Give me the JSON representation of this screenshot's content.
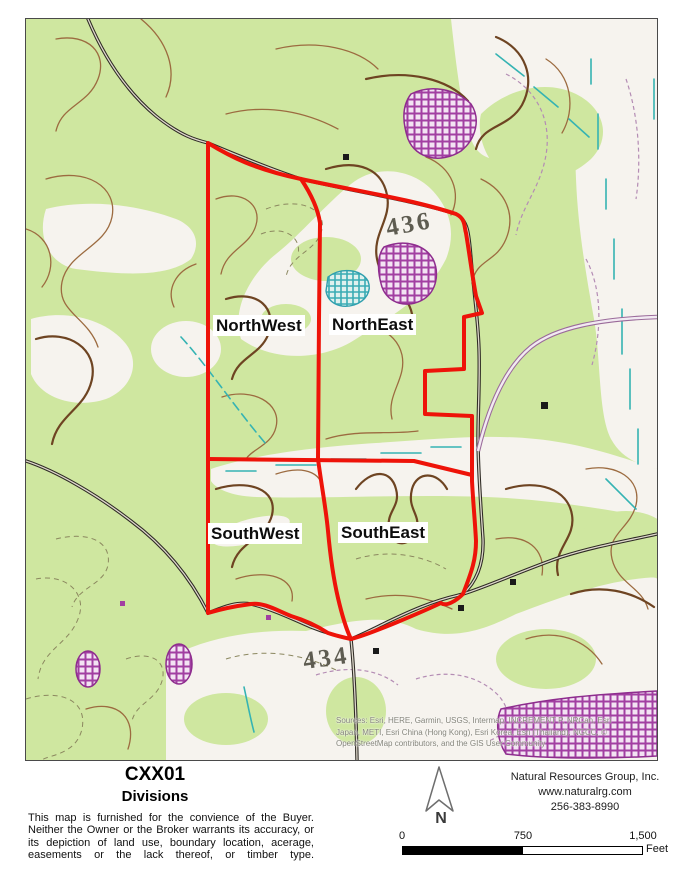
{
  "map": {
    "quadrant_labels": {
      "northwest": "NorthWest",
      "northeast": "NorthEast",
      "southwest": "SouthWest",
      "southeast": "SouthEast"
    },
    "contour_labels": {
      "upper": "436",
      "lower": "434"
    },
    "credits": {
      "line1": "Sources: Esri, HERE, Garmin, USGS, Intermap, INCREMENT P, NRCan, Esri",
      "line2": "Japan, METI, Esri China (Hong Kong), Esri Korea, Esri (Thailand), NGCC, ©",
      "line3": "OpenStreetMap contributors, and the GIS User Community"
    }
  },
  "footer": {
    "title": "CXX01",
    "subtitle": "Divisions",
    "disclaimer": "This map is furnished for the convience of the Buyer. Neither the Owner or the Broker warrants its accuracy, or its depiction of land use, boundary location, acerage, easements or the lack thereof, or timber type.",
    "north_arrow_label": "N",
    "company": {
      "name": "Natural Resources Group, Inc.",
      "website": "www.naturalrg.com",
      "phone": "256-383-8990"
    },
    "scale_bar": {
      "start_label": "0",
      "mid_label": "750",
      "end_label": "1,500",
      "unit_label": "Feet"
    }
  },
  "colors": {
    "boundary_red": "#ee1309",
    "forest_green": "#cfe7a0",
    "open_white": "#f6f3ee",
    "contour_brown": "#9c6b40",
    "contour_index_brown": "#6e4422",
    "stream_teal": "#35b3b3",
    "orchard_purple": "#a23fa2"
  }
}
